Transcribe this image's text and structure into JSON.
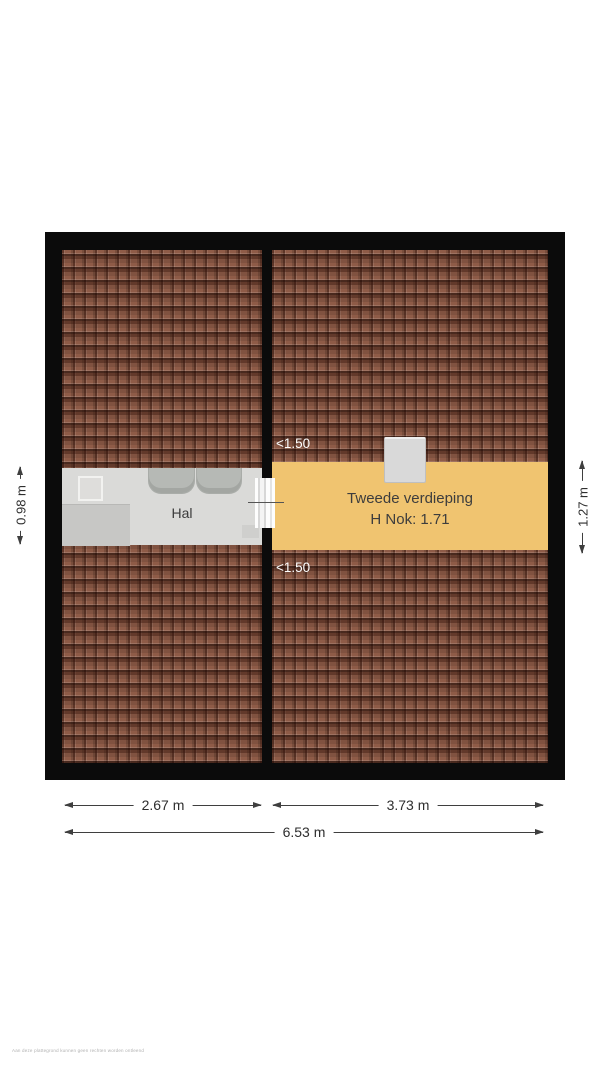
{
  "plan": {
    "hal": {
      "label": "Hal"
    },
    "attic": {
      "name": "Tweede verdieping",
      "height_note": "H Nok: 1.71"
    },
    "clearance_top": "<1.50",
    "clearance_bottom": "<1.50"
  },
  "dimensions": {
    "left_vertical": "0.98 m",
    "right_vertical": "1.27 m",
    "bottom_left": "2.67 m",
    "bottom_right": "3.73 m",
    "bottom_total": "6.53 m"
  },
  "fine_print": "Aan deze plattegrond kunnen geen rechten worden ontleend",
  "colors": {
    "roof_tile": "#8e5b47",
    "roof_tile_dark": "#3c1d12",
    "attic_band": "#f0c470",
    "hal_floor": "#dadad8",
    "wall": "#0b0b0b",
    "text": "#3b3b3b",
    "dim_line": "#3f3f3f",
    "clearance_text": "#ffffff"
  }
}
